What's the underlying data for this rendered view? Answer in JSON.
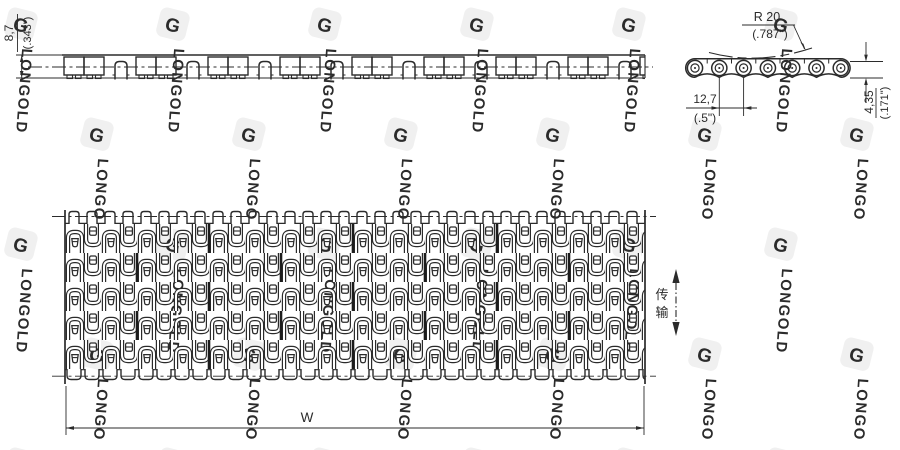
{
  "drawing_title": "modular-conveyor-belt-technical-drawing",
  "watermark": {
    "brand": "LONGOLD",
    "logo_letter": "G"
  },
  "side_view": {
    "thickness_mm": "8,7",
    "thickness_in": "(.343\")"
  },
  "end_view": {
    "radius_mm": "R 20",
    "radius_in": "(.787\")",
    "pitch_mm": "12,7",
    "pitch_in": "(.5\")",
    "edge_height_mm": "4,35",
    "edge_height_in": "(.171\")"
  },
  "plan_view": {
    "width_label": "W",
    "direction_char_top": "传",
    "direction_char_bottom": "输"
  },
  "colors": {
    "line": "#2b2b2b",
    "watermark": "#f0f0f0",
    "background": "#ffffff"
  }
}
